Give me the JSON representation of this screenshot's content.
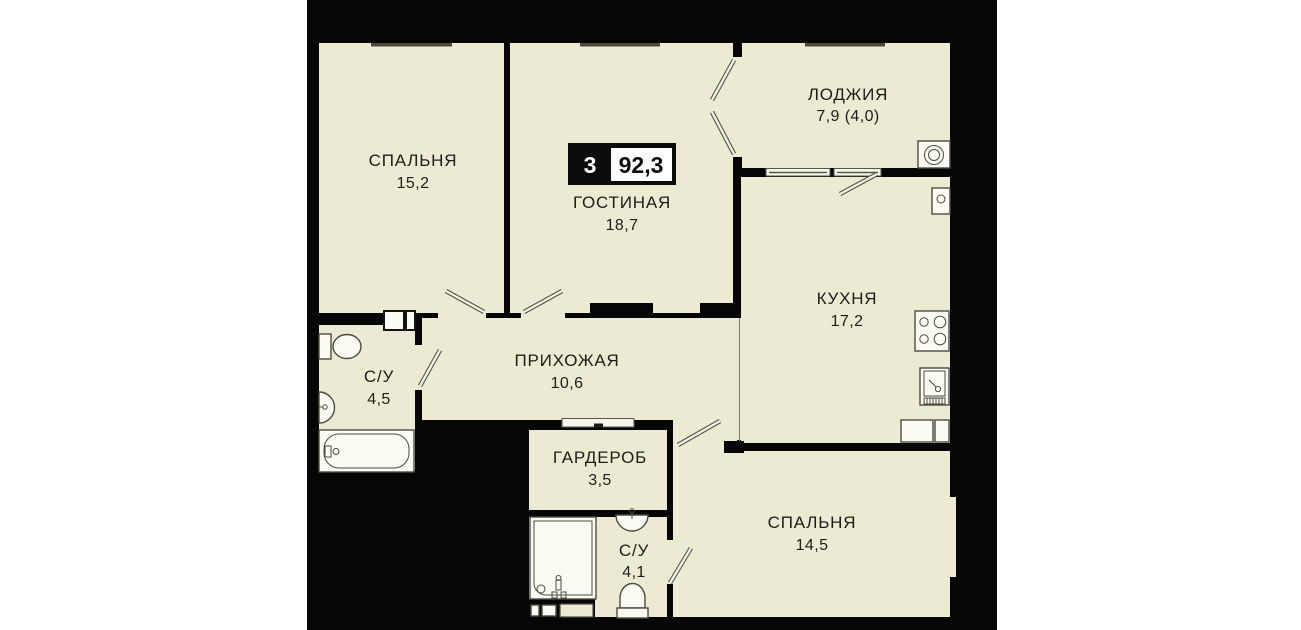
{
  "plan": {
    "badge": {
      "rooms_count": "3",
      "total_area": "92,3"
    },
    "rooms": {
      "bedroom1": {
        "name": "СПАЛЬНЯ",
        "area": "15,2"
      },
      "living": {
        "name": "ГОСТИНАЯ",
        "area": "18,7"
      },
      "loggia": {
        "name": "ЛОДЖИЯ",
        "area": "7,9 (4,0)"
      },
      "kitchen": {
        "name": "КУХНЯ",
        "area": "17,2"
      },
      "hallway": {
        "name": "ПРИХОЖАЯ",
        "area": "10,6"
      },
      "bath1": {
        "name": "С/У",
        "area": "4,5"
      },
      "wardrobe": {
        "name": "ГАРДЕРОБ",
        "area": "3,5"
      },
      "bath2": {
        "name": "С/У",
        "area": "4,1"
      },
      "bedroom2": {
        "name": "СПАЛЬНЯ",
        "area": "14,5"
      }
    },
    "icons": [
      "toilet-icon",
      "sink-icon",
      "bathtub-icon",
      "shower-icon",
      "washing-machine-icon",
      "stove-icon",
      "kitchen-sink-icon",
      "vent-box-icon",
      "cabinet-icon",
      "door-swing-icon",
      "window-icon"
    ],
    "colors": {
      "wall": "#000000",
      "floor": "#ECEAD3",
      "fixture_fill": "#fcfbf3",
      "fixture_stroke": "#4c4b40",
      "text": "#1d1d1b",
      "badge_background": "#0c0c0c",
      "badge_value_box": "#ffffff",
      "page_margin": "#ffffff"
    }
  }
}
